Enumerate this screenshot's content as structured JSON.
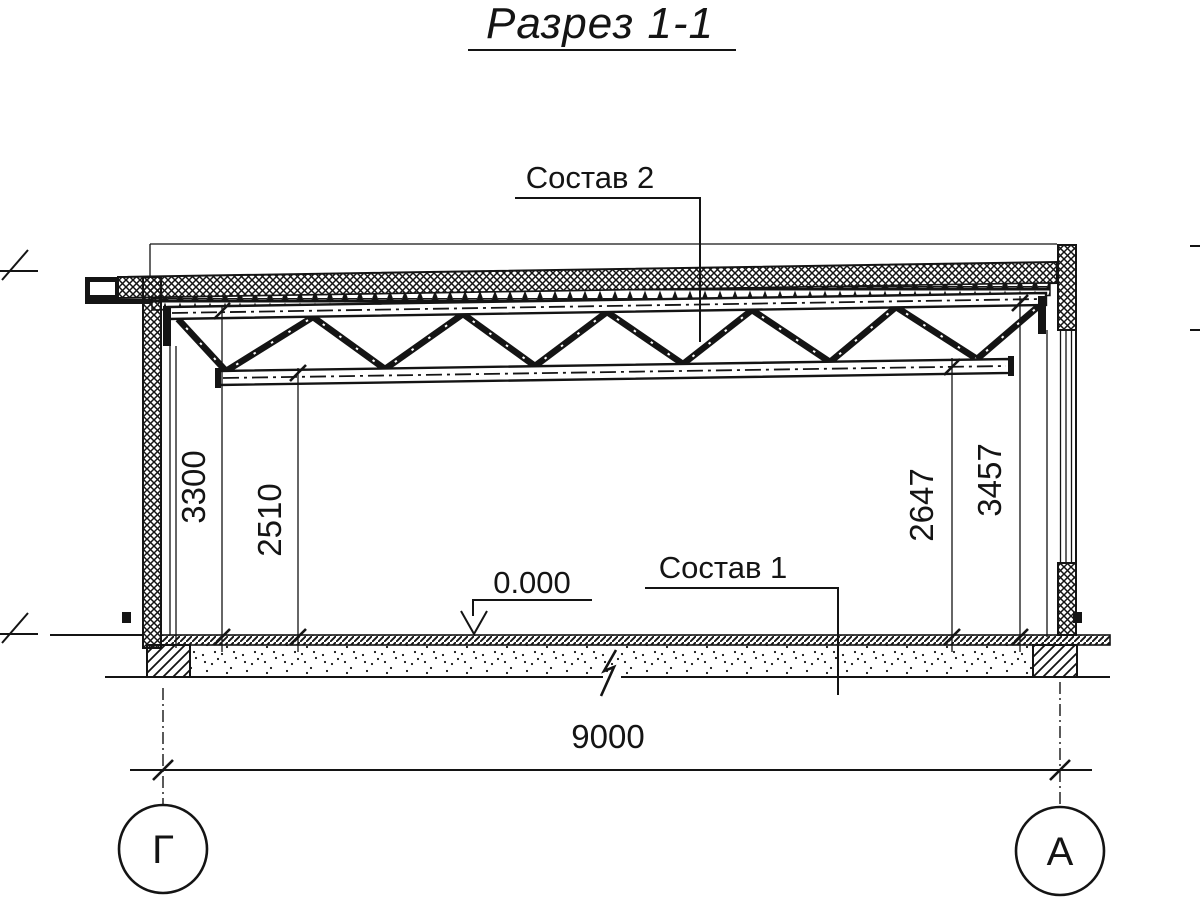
{
  "drawing": {
    "title": "Разрез 1-1",
    "callouts": {
      "roof": "Состав 2",
      "floor": "Состав 1"
    },
    "level_mark": "0.000",
    "dimensions": {
      "left_outer": "3300",
      "left_inner": "2510",
      "right_inner": "2647",
      "right_outer": "3457",
      "span": "9000"
    },
    "axes": {
      "left": "Г",
      "right": "А"
    },
    "colors": {
      "ink": "#141414",
      "background": "#ffffff"
    }
  }
}
